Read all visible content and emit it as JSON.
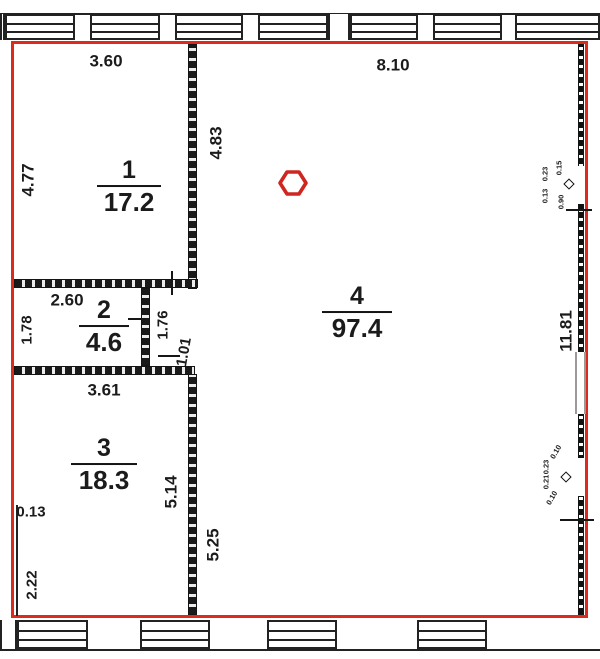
{
  "title": "Apartment floor plan with room areas",
  "colors": {
    "outline_red": "#dd2a1f",
    "wall_black": "#1a1a1a"
  },
  "rooms": [
    {
      "number": "1",
      "area": "17.2"
    },
    {
      "number": "2",
      "area": "4.6"
    },
    {
      "number": "3",
      "area": "18.3"
    },
    {
      "number": "4",
      "area": "97.4"
    }
  ],
  "dims": {
    "d360": "3.60",
    "d810": "8.10",
    "d477": "4.77",
    "d483": "4.83",
    "d260": "2.60",
    "d178": "1.78",
    "d176": "1.76",
    "d101": "1.01",
    "d361": "3.61",
    "d013": "0.13",
    "d514": "5.14",
    "d525": "5.25",
    "d222": "2.22",
    "d1181": "11.81"
  },
  "wall_details_top": [
    "0.23",
    "0.13",
    "0.15",
    "0.90"
  ],
  "wall_details_bottom": [
    "0.10",
    "0.23",
    "0.21",
    "0.10"
  ]
}
